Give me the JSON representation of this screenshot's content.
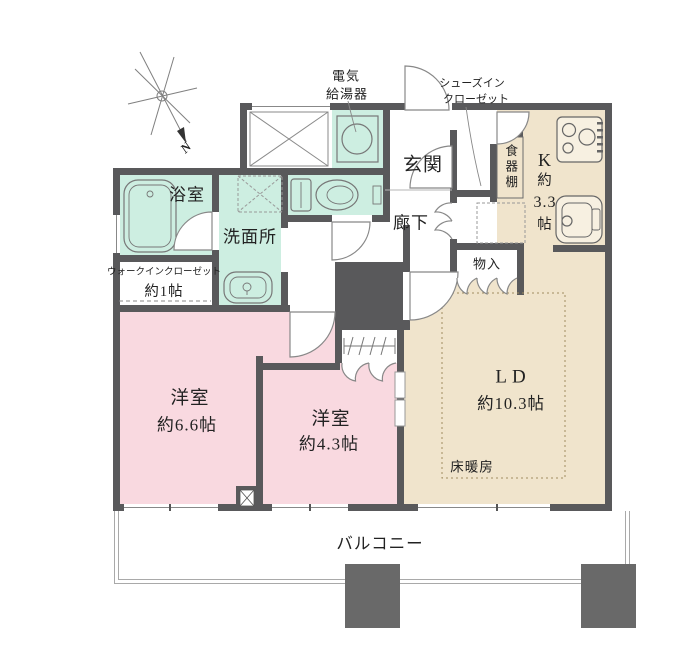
{
  "colors": {
    "wall": "#59595b",
    "mint": "#cdeee1",
    "pink": "#f9d9e0",
    "beige": "#f0e4cc",
    "pillar": "#696969",
    "text": "#222222"
  },
  "compass": {
    "north": "N"
  },
  "annotations": {
    "water_heater": [
      "電気",
      "給湯器"
    ],
    "shoes_in_closet": [
      "シューズイン",
      "クローゼット"
    ]
  },
  "rooms": {
    "bathroom": {
      "label": "浴室"
    },
    "washroom": {
      "label": "洗面所"
    },
    "walk_in_closet": {
      "label": "ウォークインクローゼット",
      "size": "約1帖"
    },
    "entrance": {
      "label": "玄関"
    },
    "corridor": {
      "label": "廊下"
    },
    "kitchen": {
      "label": "K",
      "prefix": "約",
      "size": "3.3",
      "unit": "帖"
    },
    "cupboard": {
      "label": "食器棚"
    },
    "storage": {
      "label": "物入"
    },
    "bedroom_66": {
      "label": "洋室",
      "size": "約6.6帖"
    },
    "bedroom_43": {
      "label": "洋室",
      "size": "約4.3帖"
    },
    "living_dining": {
      "label": "LD",
      "size": "約10.3帖"
    },
    "floor_heating": {
      "label": "床暖房"
    },
    "balcony": {
      "label": "バルコニー"
    }
  }
}
